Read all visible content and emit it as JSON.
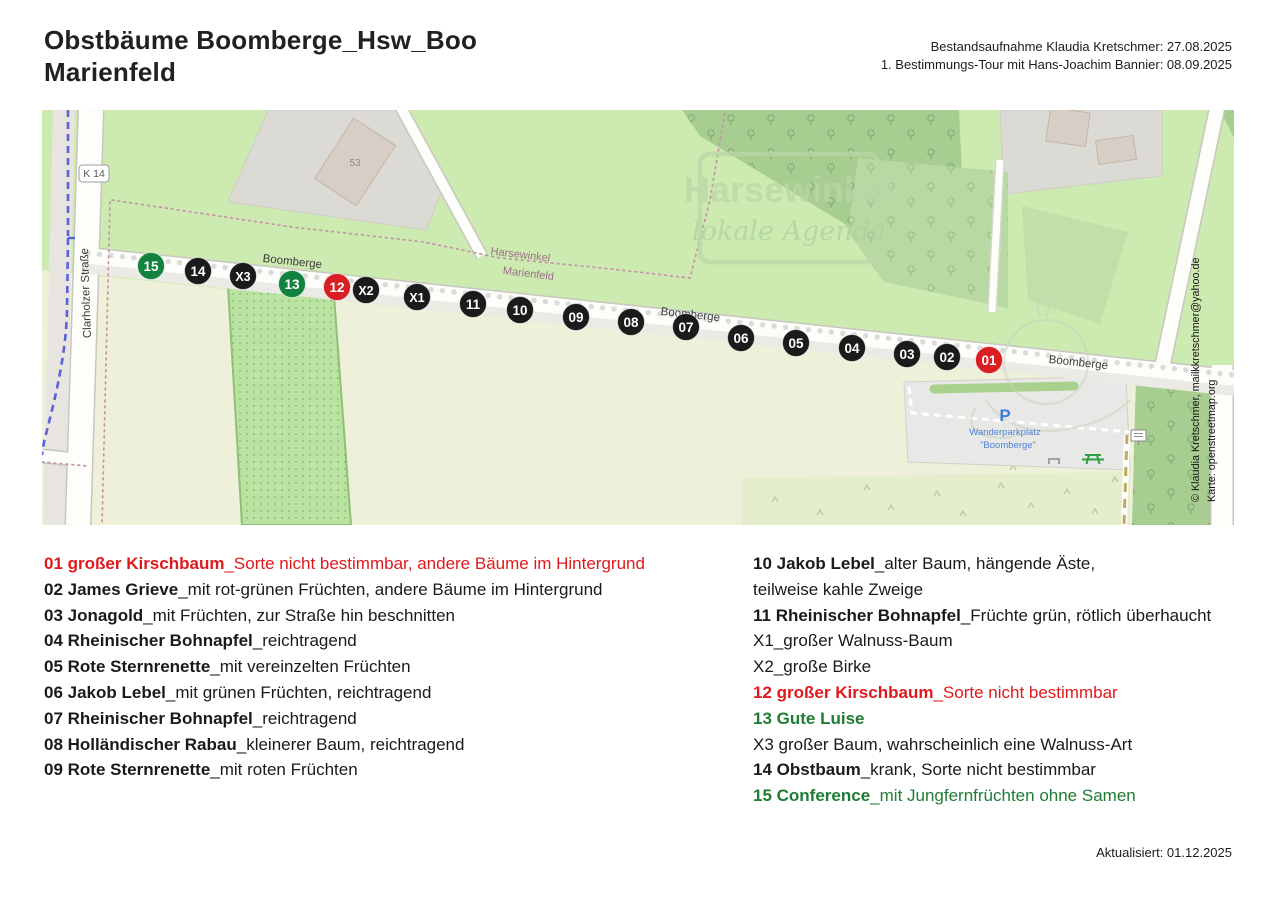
{
  "header": {
    "title_line1": "Obstbäume Boomberge_Hsw_Boo",
    "title_line2": "Marienfeld",
    "meta_line1": "Bestandsaufnahme Klaudia Kretschmer: 27.08.2025",
    "meta_line2": "1. Bestimmungs-Tour mit Hans-Joachim Bannier: 08.09.2025"
  },
  "map": {
    "street_boomberge": "Boomberge",
    "street_clarholzer": "Clarholzer Straße",
    "road_ref": "K 14",
    "building_number": "53",
    "place_labels": {
      "north": "Harsewinkel",
      "south": "Marienfeld"
    },
    "watermark": {
      "line1": "Harsewinkel",
      "line2": "lokale Agenda"
    },
    "parking": {
      "symbol": "P",
      "name_line1": "Wanderparkplatz",
      "name_line2": "\"Boomberge\""
    },
    "credits": {
      "line1": "© Klaudia Kretschmer, mailkkretschmer@yahoo.de",
      "line2": "Karte: openstreetmap.org"
    },
    "marker_colors": {
      "black": "#1b1b1b",
      "green": "#12823f",
      "red": "#d81e23"
    },
    "markers": [
      {
        "id": "15",
        "x": 109,
        "y": 156,
        "color": "green"
      },
      {
        "id": "14",
        "x": 156,
        "y": 161,
        "color": "black"
      },
      {
        "id": "X3",
        "x": 201,
        "y": 166,
        "color": "black"
      },
      {
        "id": "13",
        "x": 250,
        "y": 174,
        "color": "green"
      },
      {
        "id": "12",
        "x": 295,
        "y": 177,
        "color": "red"
      },
      {
        "id": "X2",
        "x": 324,
        "y": 180,
        "color": "black"
      },
      {
        "id": "X1",
        "x": 375,
        "y": 187,
        "color": "black"
      },
      {
        "id": "11",
        "x": 431,
        "y": 194,
        "color": "black"
      },
      {
        "id": "10",
        "x": 478,
        "y": 200,
        "color": "black"
      },
      {
        "id": "09",
        "x": 534,
        "y": 207,
        "color": "black"
      },
      {
        "id": "08",
        "x": 589,
        "y": 212,
        "color": "black"
      },
      {
        "id": "07",
        "x": 644,
        "y": 217,
        "color": "black"
      },
      {
        "id": "06",
        "x": 699,
        "y": 228,
        "color": "black"
      },
      {
        "id": "05",
        "x": 754,
        "y": 233,
        "color": "black"
      },
      {
        "id": "04",
        "x": 810,
        "y": 238,
        "color": "black"
      },
      {
        "id": "03",
        "x": 865,
        "y": 244,
        "color": "black"
      },
      {
        "id": "02",
        "x": 905,
        "y": 247,
        "color": "black"
      },
      {
        "id": "01",
        "x": 947,
        "y": 250,
        "color": "red"
      }
    ]
  },
  "legend": {
    "left": [
      {
        "lead": "01 großer Kirschbaum",
        "desc": "_Sorte nicht bestimmbar, andere Bäume im Hintergrund",
        "color": "red"
      },
      {
        "lead": "02 James Grieve",
        "desc": "_mit rot-grünen Früchten, andere Bäume im Hintergrund",
        "color": "black"
      },
      {
        "lead": "03 Jonagold",
        "desc": "_mit Früchten, zur Straße hin beschnitten",
        "color": "black"
      },
      {
        "lead": "04 Rheinischer Bohnapfel",
        "desc": "_reichtragend",
        "color": "black"
      },
      {
        "lead": "05 Rote Sternrenette",
        "desc": "_mit vereinzelten Früchten",
        "color": "black"
      },
      {
        "lead": "06 Jakob Lebel",
        "desc": "_mit grünen Früchten, reichtragend",
        "color": "black"
      },
      {
        "lead": "07 Rheinischer Bohnapfel",
        "desc": "_reichtragend",
        "color": "black"
      },
      {
        "lead": "08 Holländischer Rabau",
        "desc": "_kleinerer Baum, reichtragend",
        "color": "black"
      },
      {
        "lead": "09 Rote Sternrenette",
        "desc": "_mit roten Früchten",
        "color": "black"
      }
    ],
    "right": [
      {
        "lead": "10 Jakob Lebel",
        "desc": "_alter Baum, hängende Äste,",
        "color": "black"
      },
      {
        "lead": "",
        "desc": "teilweise kahle Zweige",
        "color": "black"
      },
      {
        "lead": "11 Rheinischer Bohnapfel",
        "desc": "_Früchte grün, rötlich überhaucht",
        "color": "black"
      },
      {
        "lead": "",
        "desc": "X1_großer Walnuss-Baum",
        "color": "black"
      },
      {
        "lead": "",
        "desc": "X2_große Birke",
        "color": "black"
      },
      {
        "lead": "12 großer Kirschbaum",
        "desc": "_Sorte nicht bestimmbar",
        "color": "red"
      },
      {
        "lead": "13 Gute Luise",
        "desc": "",
        "color": "green"
      },
      {
        "lead": "",
        "desc": "X3 großer Baum, wahrscheinlich eine Walnuss-Art",
        "color": "black"
      },
      {
        "lead": "14 Obstbaum",
        "desc": "_krank, Sorte nicht bestimmbar",
        "color": "black"
      },
      {
        "lead": "15 Conference",
        "desc": "_mit Jungfernfrüchten ohne Samen",
        "color": "green"
      }
    ]
  },
  "footer": {
    "updated": "Aktualisiert: 01.12.2025"
  }
}
